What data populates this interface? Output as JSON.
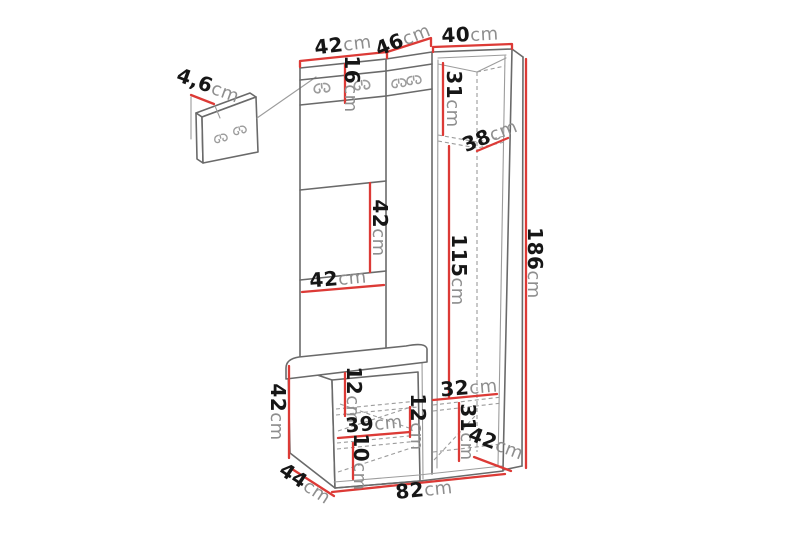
{
  "figure": {
    "type": "furniture dimension diagram",
    "subject": "Hallway wardrobe set with wall hook panel, corner cabinet and storage bench",
    "unit": "cm"
  },
  "colors": {
    "background": "#ffffff",
    "outline": "#6a6a6a",
    "hidden_line": "#9c9c9c",
    "dimension_line": "#dc3a36",
    "label_number": "#161616",
    "label_unit": "#8e8e8e"
  },
  "labels": {
    "wall_panel_depth": {
      "num": "4,6",
      "unit": "cm"
    },
    "top_left_width": {
      "num": "42",
      "unit": "cm"
    },
    "top_corner_width": {
      "num": "46",
      "unit": "cm"
    },
    "top_right_width": {
      "num": "40",
      "unit": "cm"
    },
    "hook_panel_height": {
      "num": "16",
      "unit": "cm"
    },
    "cabinet_top_section_height": {
      "num": "31",
      "unit": "cm"
    },
    "cabinet_shelf_depth": {
      "num": "38",
      "unit": "cm"
    },
    "open_section_height": {
      "num": "42",
      "unit": "cm"
    },
    "open_section_width": {
      "num": "42",
      "unit": "cm"
    },
    "hanging_space_height": {
      "num": "115",
      "unit": "cm"
    },
    "total_height": {
      "num": "186",
      "unit": "cm"
    },
    "bench_height": {
      "num": "42",
      "unit": "cm"
    },
    "seat_thickness": {
      "num": "12",
      "unit": "cm"
    },
    "drawer_width": {
      "num": "39",
      "unit": "cm"
    },
    "drawer_height": {
      "num": "12",
      "unit": "cm"
    },
    "plinth_height": {
      "num": "10",
      "unit": "cm"
    },
    "cabinet_bottom_section_height": {
      "num": "32",
      "unit": "cm"
    },
    "cabinet_lower_section_height": {
      "num": "31",
      "unit": "cm"
    },
    "cabinet_depth": {
      "num": "42",
      "unit": "cm"
    },
    "bench_depth": {
      "num": "44",
      "unit": "cm"
    },
    "total_width": {
      "num": "82",
      "unit": "cm"
    }
  }
}
